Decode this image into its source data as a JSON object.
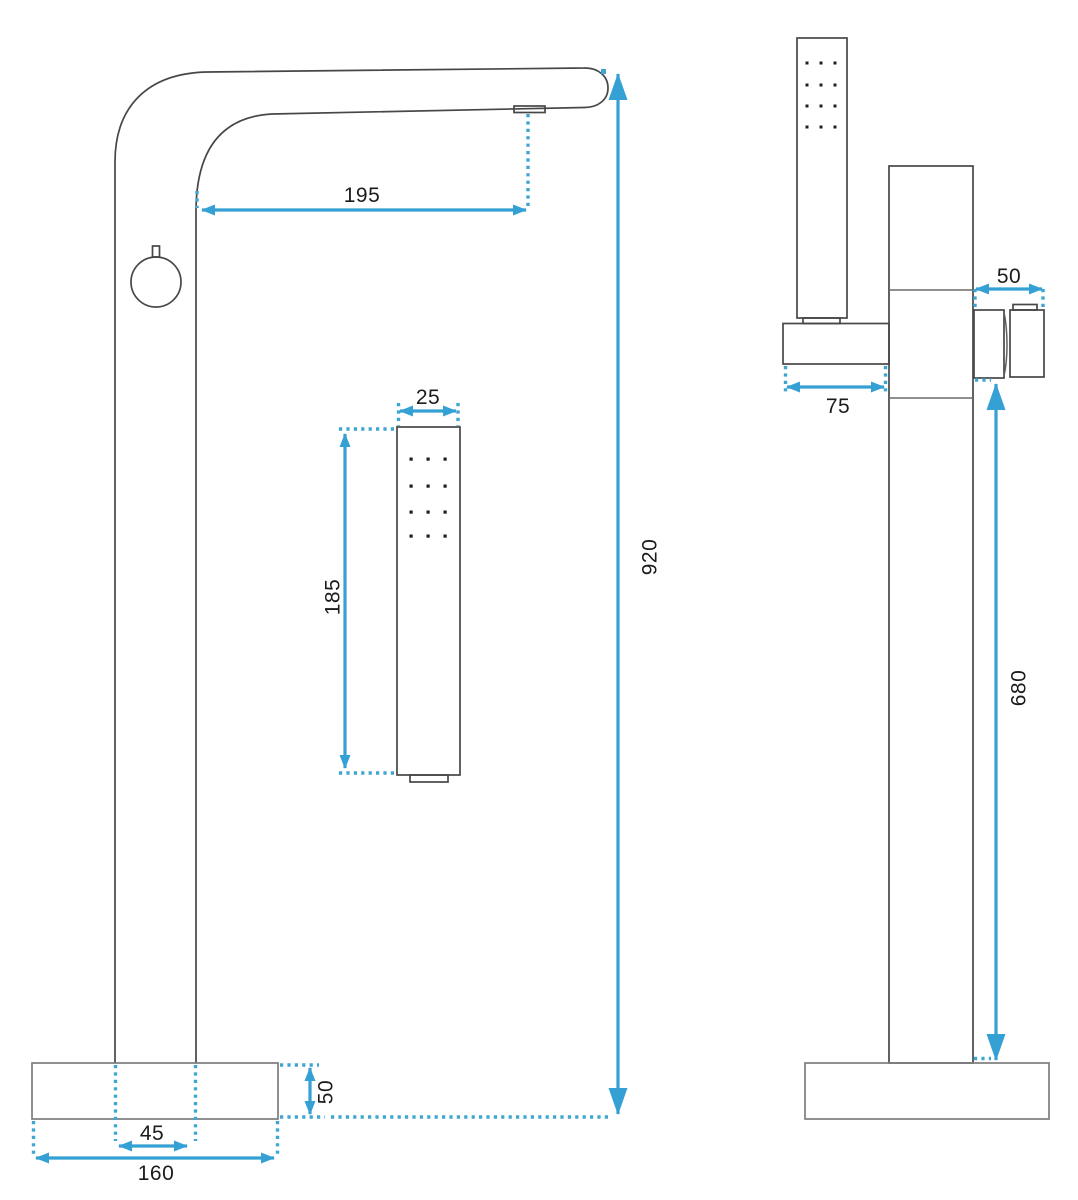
{
  "drawing": {
    "kind": "freestanding-bath-faucet-dimension-drawing",
    "colors": {
      "accent": "#35A0D3",
      "outline": "#474747",
      "base_outline": "#7D7D7D",
      "label_text": "#1B1B1B",
      "background": "#FFFFFF"
    },
    "front_view": {
      "dimensions": {
        "spout_reach": "195",
        "overall_height": "920",
        "handshower_width": "25",
        "handshower_length": "185",
        "base_height": "50",
        "column_width": "45",
        "base_width": "160"
      }
    },
    "side_view": {
      "dimensions": {
        "handle_depth": "50",
        "holder_depth": "75",
        "outlet_height": "680"
      }
    }
  }
}
